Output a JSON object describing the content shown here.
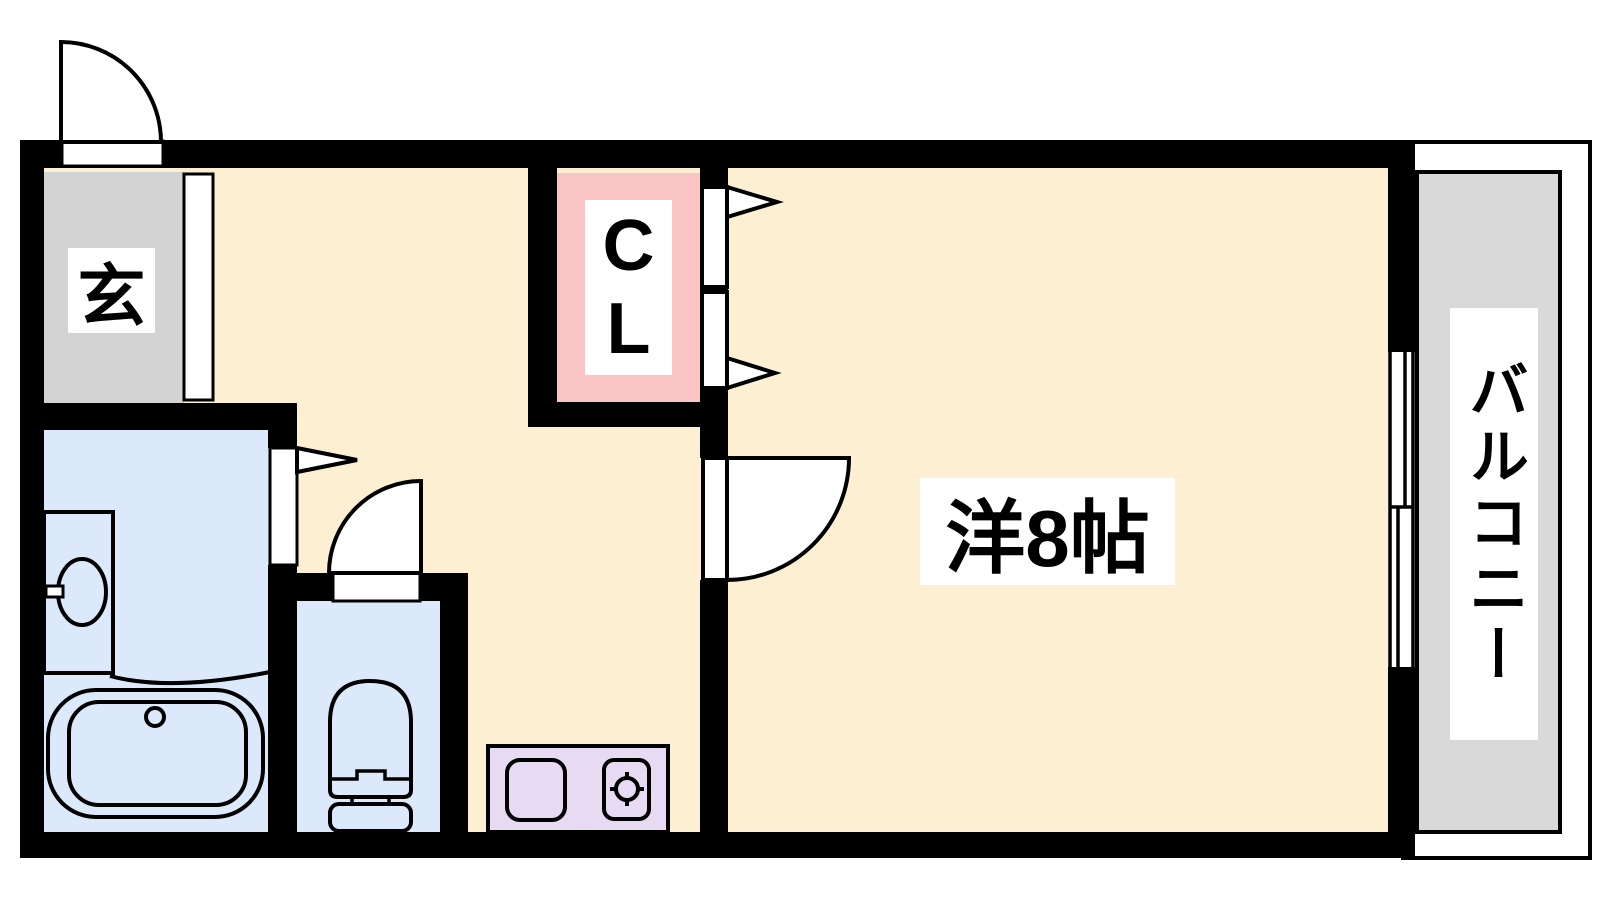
{
  "plan": {
    "type": "apartment-floor-plan",
    "labels": {
      "entrance": "玄",
      "closet_line1": "C",
      "closet_line2": "L",
      "main_room": "洋8帖",
      "balcony": "バルコニー"
    },
    "colors": {
      "background": "#ffffff",
      "wall": "#000000",
      "hall_room_floor": "#FCEFD2",
      "entrance_floor": "#D3D3D3",
      "closet_floor": "#FBC4C4",
      "bath_floor": "#DCE9FB",
      "kitchen_counter": "#E7DAF3",
      "balcony_floor": "#D9D9D9",
      "label_background": "#ffffff",
      "line": "#000000"
    },
    "fixtures": [
      "entrance-door-swing",
      "closet-double-doors-with-arrows",
      "bathroom-sliding-door-arrow",
      "toilet-door-swing",
      "room-door-swing",
      "washbasin",
      "bathtub",
      "toilet",
      "kitchen-sink",
      "gas-burner",
      "sliding-window-to-balcony"
    ]
  }
}
